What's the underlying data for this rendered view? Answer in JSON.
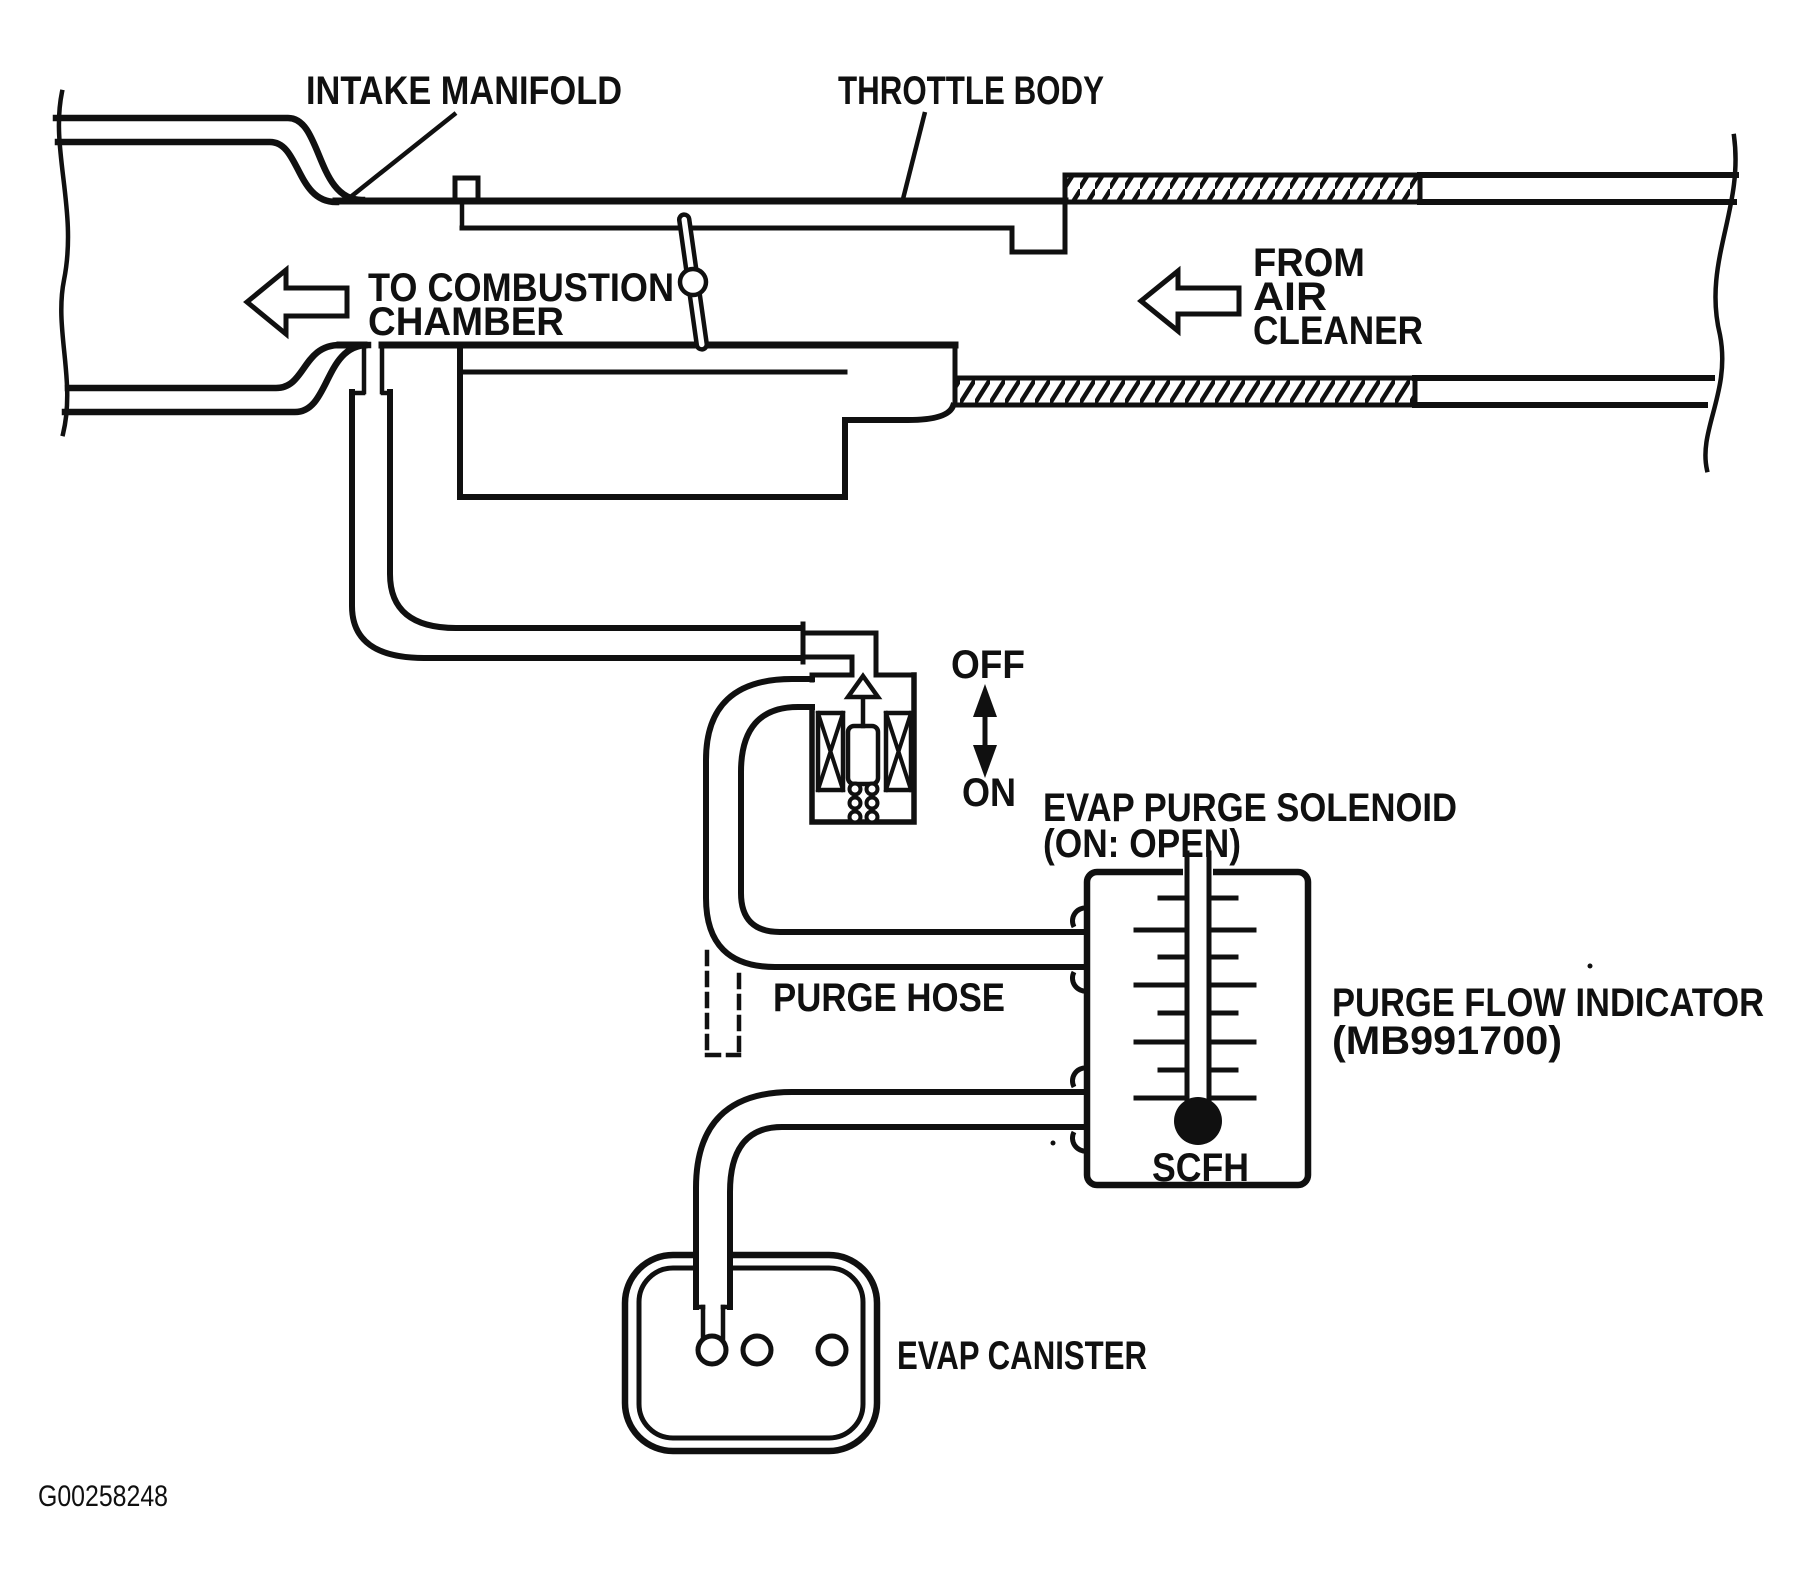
{
  "diagram": {
    "figure_id": "G00258248",
    "labels": {
      "intake_manifold": "INTAKE MANIFOLD",
      "throttle_body": "THROTTLE BODY",
      "to_combustion_1": "TO COMBUSTION",
      "to_combustion_2": "CHAMBER",
      "from_air_1": "FROM",
      "from_air_2": "AIR",
      "from_air_3": "CLEANER",
      "solenoid_off": "OFF",
      "solenoid_on": "ON",
      "evap_purge_solenoid_1": "EVAP PURGE SOLENOID",
      "evap_purge_solenoid_2": "(ON: OPEN)",
      "purge_hose": "PURGE HOSE",
      "purge_flow_indicator_1": "PURGE FLOW INDICATOR",
      "purge_flow_indicator_2": "(MB991700)",
      "flow_unit": "SCFH",
      "evap_canister": "EVAP CANISTER"
    },
    "colors": {
      "ink": "#101010",
      "background": "#ffffff"
    }
  }
}
